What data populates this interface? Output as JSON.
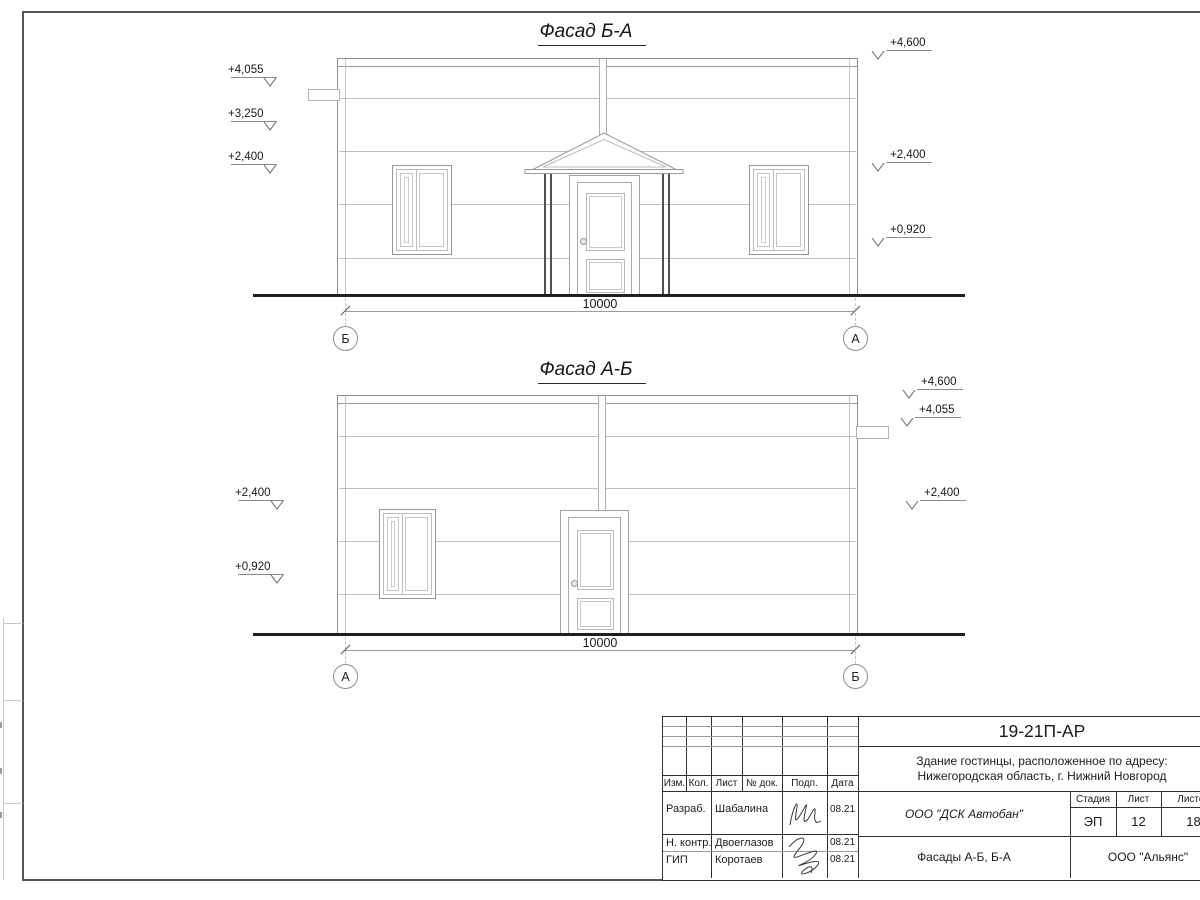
{
  "drawing": {
    "facade1": {
      "title": "Фасад Б-А",
      "dimension": "10000",
      "axis_left": "Б",
      "axis_right": "А",
      "elev_left": [
        "+4,055",
        "+3,250",
        "+2,400"
      ],
      "elev_right": [
        "+4,600",
        "+2,400",
        "+0,920"
      ]
    },
    "facade2": {
      "title": "Фасад А-Б",
      "dimension": "10000",
      "axis_left": "А",
      "axis_right": "Б",
      "elev_left": [
        "+2,400",
        "+0,920"
      ],
      "elev_right": [
        "+4,600",
        "+4,055",
        "+2,400"
      ]
    }
  },
  "title_block": {
    "doc_number": "19-21П-АР",
    "project_line1": "Здание гостинцы, расположенное по адресу:",
    "project_line2": "Нижегородская область, г. Нижний Новгород",
    "header_cols": [
      "Изм.",
      "Кол.",
      "Лист",
      "№ док.",
      "Подп.",
      "Дата"
    ],
    "rows": [
      {
        "role": "Разраб.",
        "name": "Шабалина",
        "date": "08.21"
      },
      {
        "role": "Н. контр.",
        "name": "Двоеглазов",
        "date": "08.21"
      },
      {
        "role": "ГИП",
        "name": "Коротаев",
        "date": "08.21"
      }
    ],
    "contractor": "ООО \"ДСК Автобан\"",
    "sheet_title": "Фасады А-Б, Б-А",
    "client": "ООО \"Альянс\"",
    "stage_label": "Стадия",
    "sheet_label": "Лист",
    "sheets_label": "Листов",
    "stage_value": "ЭП",
    "sheet_value": "12",
    "sheets_value": "18"
  },
  "colors": {
    "line_light": "#c0c0c4",
    "line_medium": "#9a9a9e",
    "line_dark": "#2f2f33",
    "ground": "#1f1f22",
    "text": "#1b1b1e"
  }
}
